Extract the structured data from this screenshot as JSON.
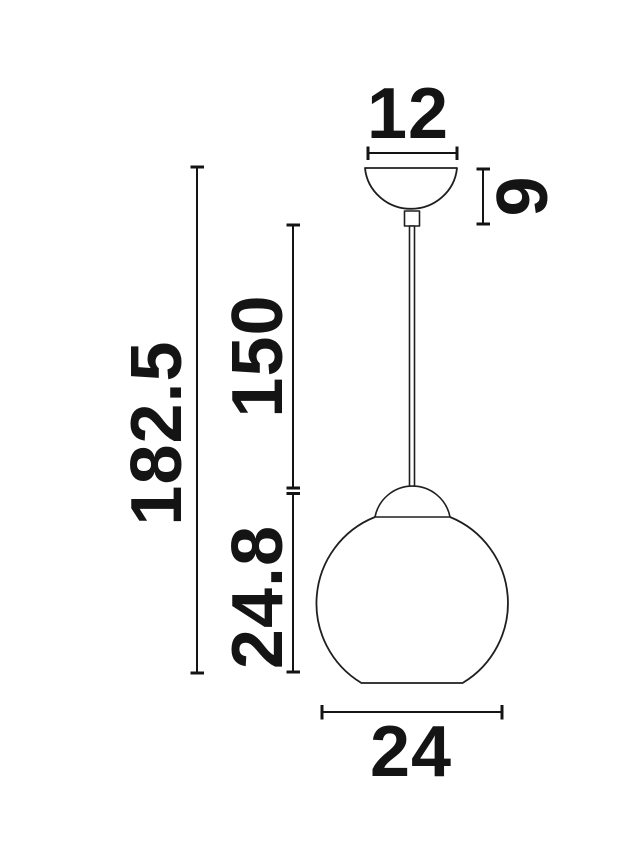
{
  "figure": {
    "background_color": "#ffffff",
    "line_color": "#1f1f1f",
    "text_color": "#141414",
    "dimensions": {
      "canopy_width": "12",
      "canopy_height": "9",
      "cord_length": "150",
      "shade_height": "24.8",
      "overall_height": "182.5",
      "shade_diameter": "24"
    }
  }
}
